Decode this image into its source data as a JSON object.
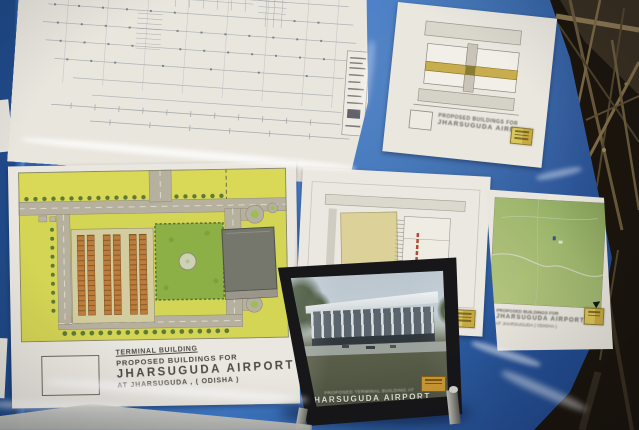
{
  "scene": {
    "type": "photograph",
    "subject": "Architectural drawings and a framed rendering for Jharsuguda Airport terminal building displayed on a blue site board, scaffolding behind"
  },
  "colors": {
    "board_blue": "#3068b5",
    "board_blue_light": "#3d78c9",
    "board_blue_dark": "#1c458b",
    "paper_white": "#eae7df",
    "plan_yellow_green": "#d6d54f",
    "plan_park_green": "#8bb041",
    "plan_road_grey": "#b6b09e",
    "plan_stall_orange": "#c07c38",
    "terminal_block_grey": "#75766c",
    "frame_black": "#17171a",
    "stamp_yellow": "#d6bd45",
    "stamp_orange": "#cf9a2e",
    "scaffold_brown": "#6e5c3b",
    "background_dark": "#1b150d"
  },
  "board": {
    "site_plan": {
      "title_lines": [
        "TERMINAL BUILDING",
        "PROPOSED BUILDINGS FOR",
        "JHARSUGUDA  AIRPORT",
        "AT JHARSUGUDA , ( ODISHA )"
      ]
    },
    "right_map": {
      "title_lines": [
        "PROPOSED BUILDINGS FOR",
        "JHARSUGUDA  AIRPORT",
        "AT JHARSUGUDA ( ODISHA )"
      ]
    },
    "top_right_plan": {
      "title_lines": [
        "PROPOSED BUILDINGS FOR",
        "JHARSUGUDA AIRPORT"
      ]
    },
    "middle_plan": {
      "marking": "87"
    },
    "framed_rendering": {
      "caption_lines": [
        "PROPOSED TERMINAL BUILDING AT",
        "JHARSUGUDA  AIRPORT",
        "AT ODISHA"
      ]
    }
  }
}
